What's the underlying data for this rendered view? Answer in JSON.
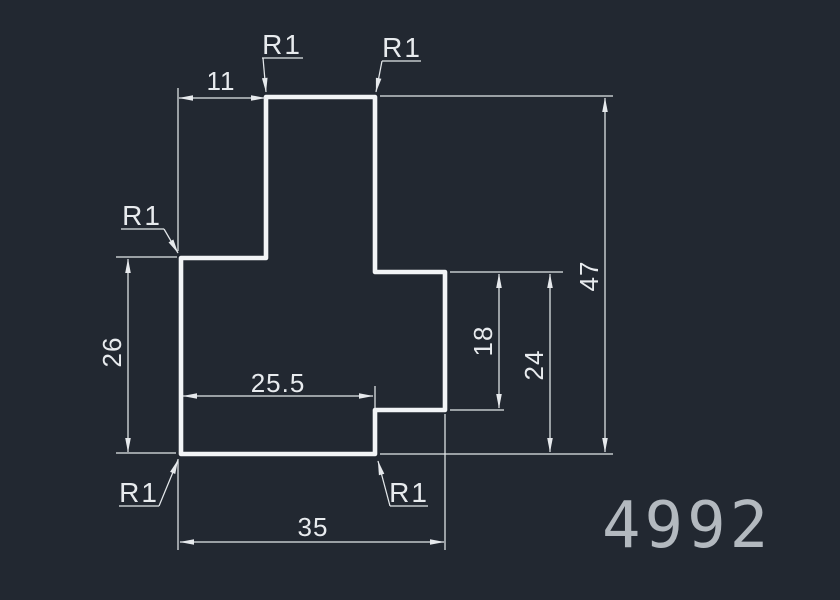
{
  "title": "CAD part profile drawing",
  "part_number": "4992",
  "colors": {
    "background": "#222831",
    "outline": "#f2f4f6",
    "dimension_lines": "#e3e7ea",
    "dimension_text": "#e8ebee",
    "part_number_text": "#b3b9bf"
  },
  "radius_labels": [
    "R1",
    "R1",
    "R1",
    "R1",
    "R1"
  ],
  "dimensions": {
    "tab_offset": "11",
    "left_height": "26",
    "lower_width": "25.5",
    "right_notch_height": "18",
    "right_height": "24",
    "overall_height": "47",
    "overall_width": "35"
  }
}
